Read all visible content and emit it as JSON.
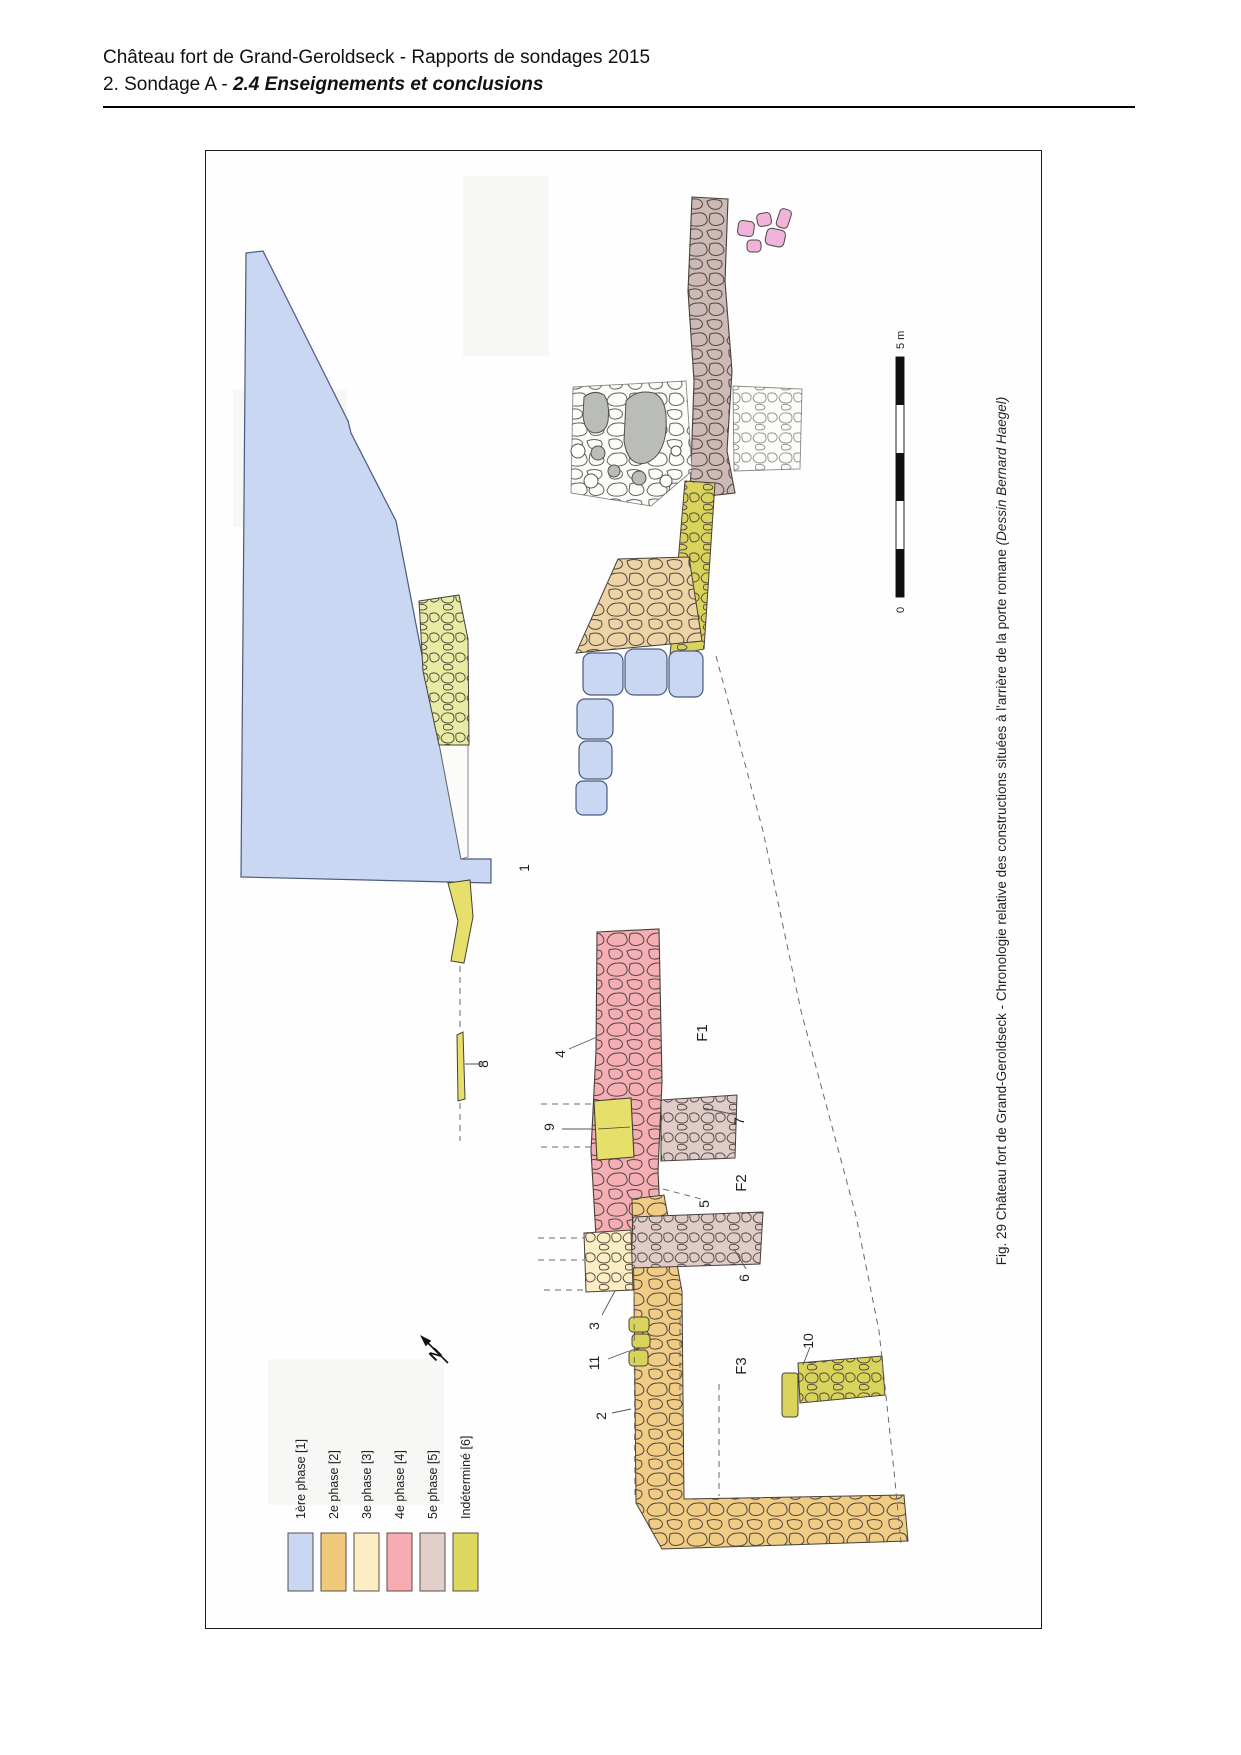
{
  "header": {
    "title": "Château fort de Grand-Geroldseck - Rapports de sondages 2015",
    "subtitle_prefix": "2. Sondage A - ",
    "subtitle_emphasis": "2.4 Enseignements et conclusions"
  },
  "figure": {
    "caption_text": "Fig. 29 Château fort de Grand-Geroldseck - Chronologie relative des constructions situées à l'arrière de la porte romane ",
    "caption_credit": "(Dessin Bernard Haegel)",
    "north_label": "N",
    "scale_bar": {
      "min_label": "0",
      "max_label": "5 m"
    },
    "legend": {
      "items": [
        {
          "label": "1ère phase [1]",
          "color": "#cad7f3"
        },
        {
          "label": "2e phase [2]",
          "color": "#f0ca7a"
        },
        {
          "label": "3e phase [3]",
          "color": "#fdedc4"
        },
        {
          "label": "4e phase [4]",
          "color": "#f7acb4"
        },
        {
          "label": "5e phase [5]",
          "color": "#e2cfca"
        },
        {
          "label": "Indéterminé [6]",
          "color": "#dcd75e"
        }
      ]
    },
    "plan_labels": [
      {
        "text": "1"
      },
      {
        "text": "2"
      },
      {
        "text": "3"
      },
      {
        "text": "4"
      },
      {
        "text": "5"
      },
      {
        "text": "6"
      },
      {
        "text": "7"
      },
      {
        "text": "8"
      },
      {
        "text": "9"
      },
      {
        "text": "10"
      },
      {
        "text": "11"
      },
      {
        "text": "F1"
      },
      {
        "text": "F2"
      },
      {
        "text": "F3"
      }
    ],
    "phase_colors": {
      "phase1_blue": "#cad7f3",
      "phase2_orange": "#f1cc85",
      "phase2_tan": "#eed4a5",
      "phase3_paleyellow": "#fdedc4",
      "phase4_pink": "#f5aeb4",
      "phase5_dark": "#cdb9b5",
      "phase5_light": "#dfccc8",
      "indeterminate_olive": "#d9d35c",
      "indeterminate_yellow": "#e6df69",
      "indeterminate_light": "#e8eba3",
      "scatter_pink": "#f0b3d9",
      "stone_gray": "#b9bcb8"
    }
  }
}
